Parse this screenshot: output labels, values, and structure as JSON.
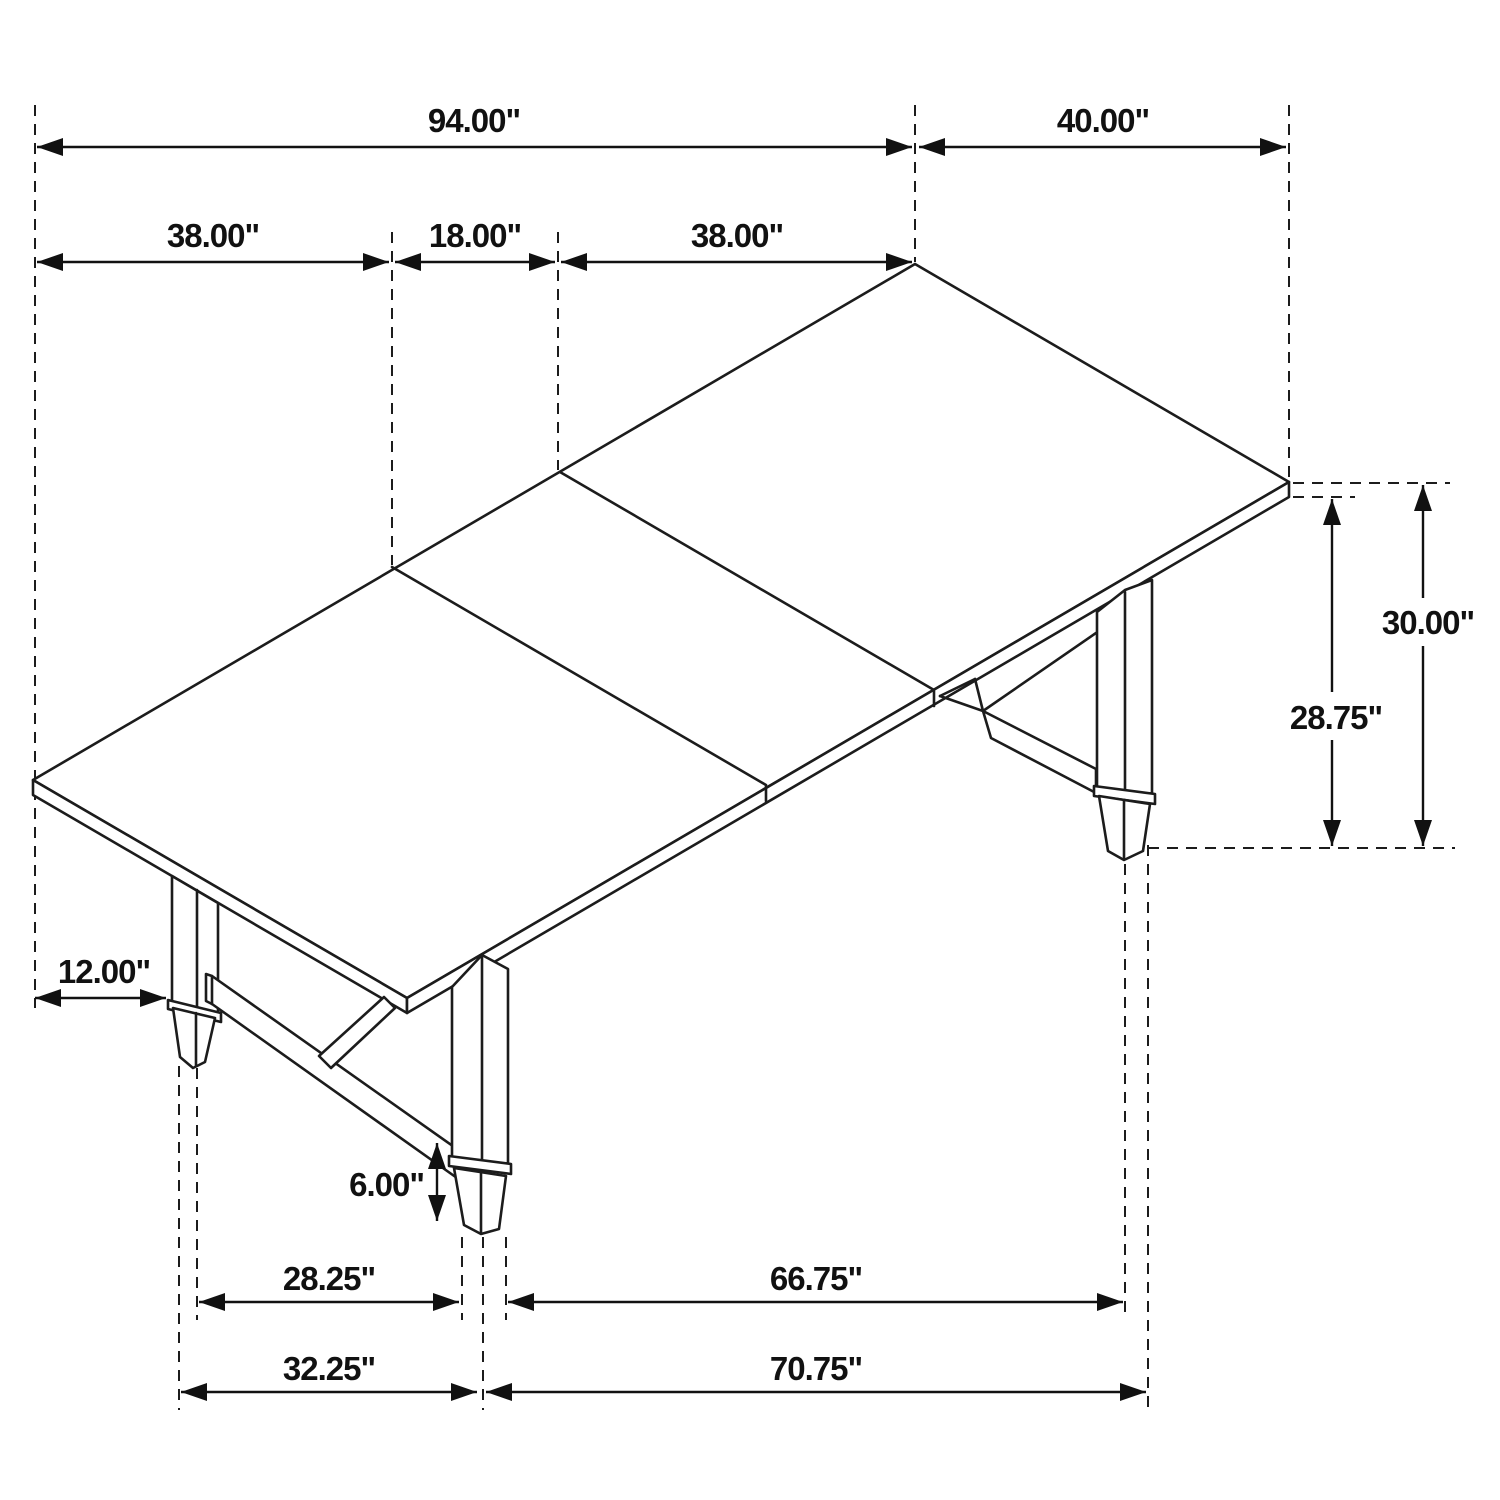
{
  "diagram": {
    "type": "furniture-dimension-drawing",
    "subject": "Extendable rectangular dining table with trestle base, isometric line drawing with dimensions",
    "units": "inches",
    "colors": {
      "line": "#1c1c1c",
      "background": "#ffffff"
    },
    "dims": {
      "total_length": "94.00\"",
      "end_width": "40.00\"",
      "top_section_left": "38.00\"",
      "leaf_section": "18.00\"",
      "top_section_right": "38.00\"",
      "overall_height": "30.00\"",
      "underside_height": "28.75\"",
      "leg_inset": "12.00\"",
      "foot_height": "6.00\"",
      "leg_span_inner_left": "28.25\"",
      "leg_span_inner_right": "66.75\"",
      "leg_span_outer_left": "32.25\"",
      "leg_span_outer_right": "70.75\""
    },
    "measurements": [
      {
        "value": 94.0,
        "display": "94.00\""
      },
      {
        "value": 40.0,
        "display": "40.00\""
      },
      {
        "value": 38.0,
        "display": "38.00\""
      },
      {
        "value": 18.0,
        "display": "18.00\""
      },
      {
        "value": 38.0,
        "display": "38.00\""
      },
      {
        "value": 30.0,
        "display": "30.00\""
      },
      {
        "value": 28.75,
        "display": "28.75\""
      },
      {
        "value": 12.0,
        "display": "12.00\""
      },
      {
        "value": 6.0,
        "display": "6.00\""
      },
      {
        "value": 28.25,
        "display": "28.25\""
      },
      {
        "value": 66.75,
        "display": "66.75\""
      },
      {
        "value": 32.25,
        "display": "32.25\""
      },
      {
        "value": 70.75,
        "display": "70.75\""
      }
    ]
  }
}
